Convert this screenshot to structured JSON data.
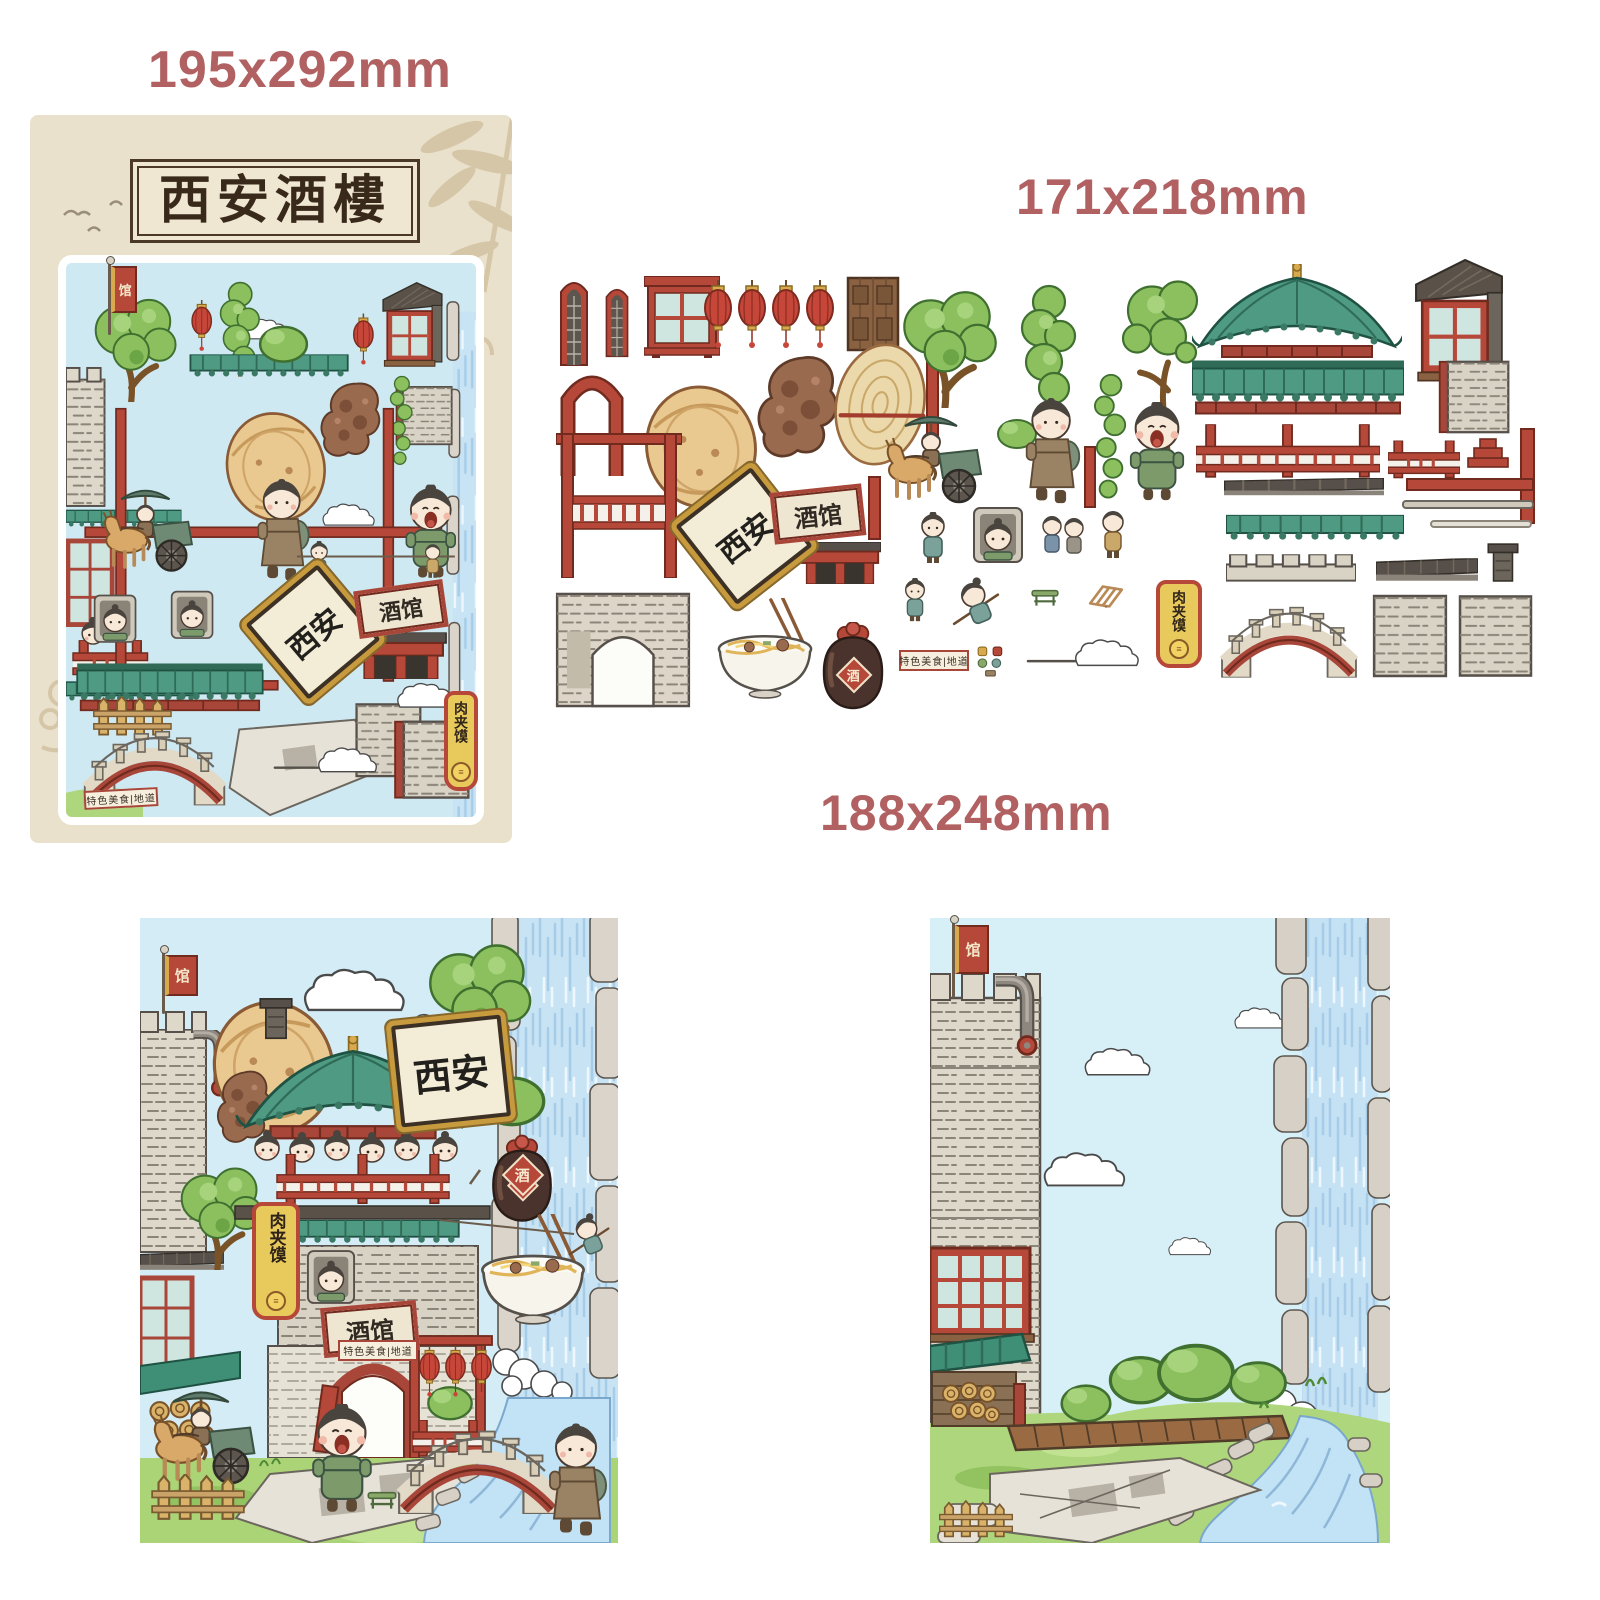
{
  "labels": {
    "poster_size": "195x292mm",
    "sheet_size": "171x218mm",
    "scene_size": "188x248mm"
  },
  "poster": {
    "title": "西安酒樓"
  },
  "signs": {
    "city": "西安",
    "tavern": "酒馆",
    "roujiamo": "肉夹馍",
    "flag": "馆",
    "wine": "酒",
    "specialty": "特色美食|地道",
    "burger_icon": "≡"
  },
  "colors": {
    "label_text": "#b16161",
    "accent_red": "#b6483a",
    "roof_green": "#4e9a82",
    "parchment": "#eae1cc",
    "sky": "#d3ecf6",
    "stone": "#d9d3c6",
    "grass": "#abd477",
    "water": "#c5e2f4"
  },
  "stickers": {
    "items": [
      "arch-window-a",
      "arch-window-b",
      "lattice-window",
      "lantern-1",
      "lantern-2",
      "lantern-3",
      "lantern-4",
      "wood-door",
      "red-arch",
      "baked-bun",
      "braised-meat",
      "flatbread-with-chopstick",
      "red-pole-a",
      "timber-frame",
      "xian-plaque",
      "tavern-sign",
      "gate-lintel",
      "red-pole-b",
      "stone-arch-wall",
      "noodle-bowl",
      "wine-jar",
      "pine-tree",
      "cypress-tree",
      "bush",
      "hanging-vine",
      "tall-tree",
      "horse-cart-with-driver",
      "walking-boy",
      "shouting-boy",
      "red-pole-c",
      "small-girl",
      "window-girl",
      "children-pair",
      "toddler",
      "small-boy",
      "flying-girl",
      "green-bench",
      "wood-rack",
      "specialty-sign",
      "mini-props",
      "cloud-whoosh",
      "roujiamo-banner",
      "pavilion-roof",
      "gable-window",
      "tiled-ridge-long",
      "brick-panel-red-edge",
      "railing-long",
      "railing-short",
      "red-bracket",
      "red-pole-d",
      "dark-eave-long",
      "red-beam",
      "gray-pole-1",
      "gray-pole-2",
      "tiled-ridge-short",
      "battlement-wall",
      "dark-eave",
      "chimney",
      "arch-bridge",
      "stone-panel-1",
      "stone-panel-2"
    ]
  }
}
